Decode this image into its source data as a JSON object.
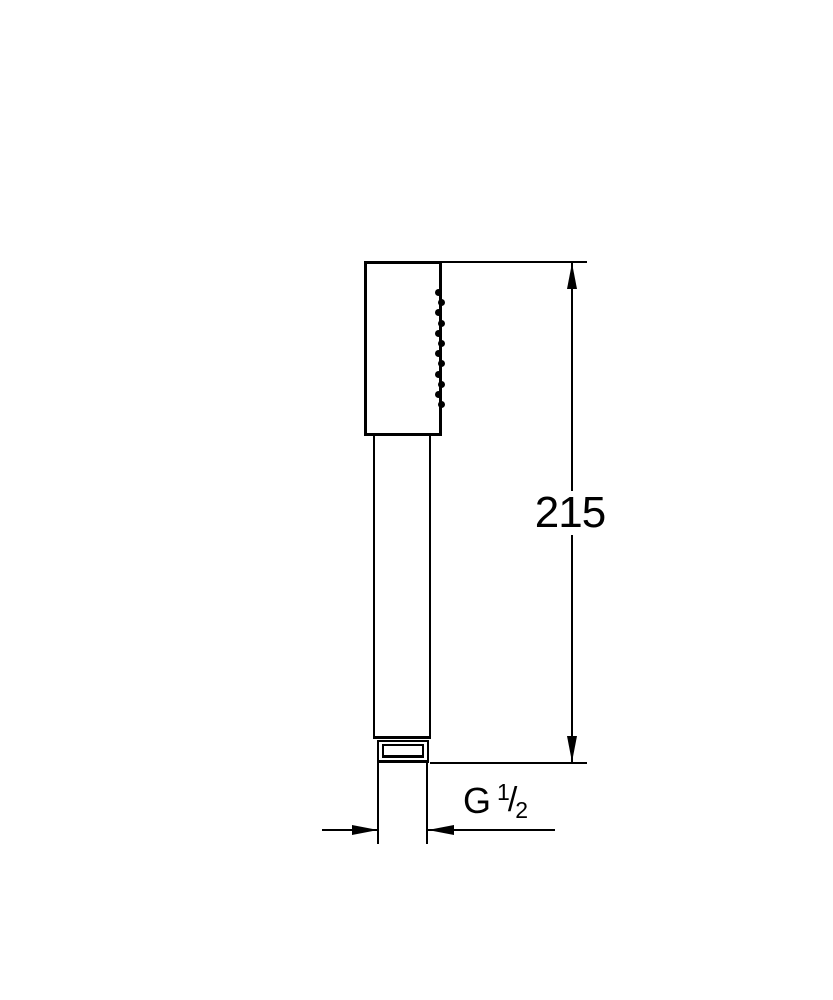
{
  "colors": {
    "line": "#000000",
    "background": "#ffffff"
  },
  "diagram": {
    "type": "technical-dimension-drawing",
    "subject_label": "hand shower side view",
    "nozzle_dot_count": 12,
    "height_dimension": {
      "value": "215"
    },
    "thread_dimension": {
      "prefix": "G",
      "numerator": "1",
      "separator": "/",
      "denominator": "2",
      "full": "G 1/2"
    }
  }
}
